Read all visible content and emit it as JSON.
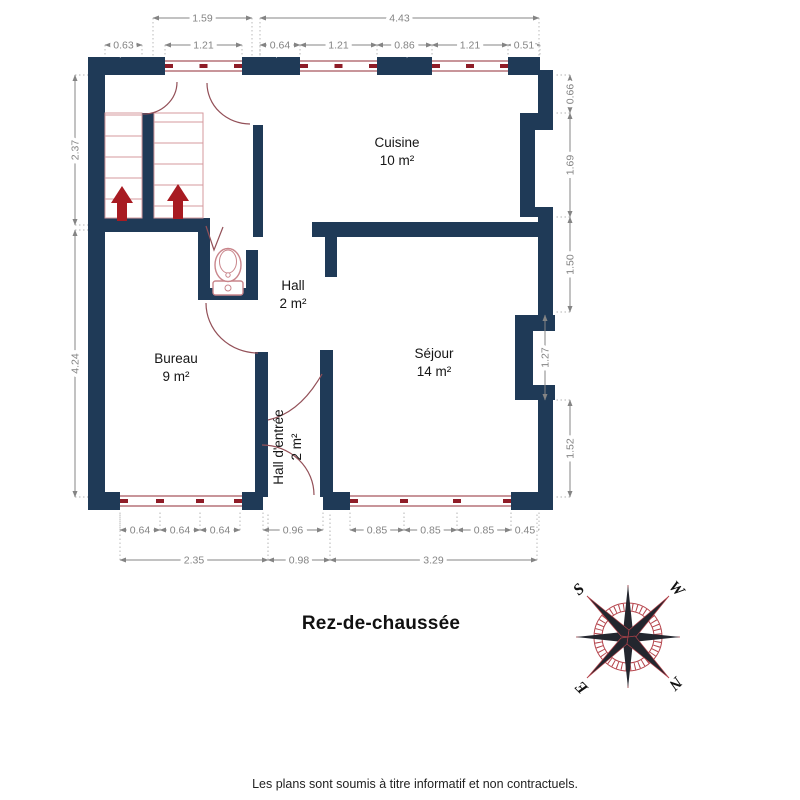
{
  "plan": {
    "title": "Rez-de-chaussée",
    "disclaimer": "Les plans sont soumis à titre informatif et non contractuels.",
    "rooms": [
      {
        "name": "Cuisine",
        "area": "10 m²",
        "x": 397,
        "y": 147,
        "rotate": 0
      },
      {
        "name": "Hall",
        "area": "2 m²",
        "x": 293,
        "y": 290,
        "rotate": 0
      },
      {
        "name": "Bureau",
        "area": "9 m²",
        "x": 176,
        "y": 363,
        "rotate": 0
      },
      {
        "name": "Séjour",
        "area": "14 m²",
        "x": 434,
        "y": 358,
        "rotate": 0
      },
      {
        "name": "Hall d'entrée",
        "area": "2 m²",
        "x": 283,
        "y": 447,
        "rotate": -90
      }
    ],
    "dimensions": {
      "horizontal": [
        {
          "value": "1.59",
          "x1": 153,
          "x2": 252,
          "y": 18,
          "ext": 57
        },
        {
          "value": "4.43",
          "x1": 260,
          "x2": 539,
          "y": 18,
          "ext": 57
        },
        {
          "value": "0.63",
          "x1": 105,
          "x2": 142,
          "y": 45,
          "ext": 57
        },
        {
          "value": "1.21",
          "x1": 165,
          "x2": 242,
          "y": 45,
          "ext": 57
        },
        {
          "value": "0.64",
          "x1": 260,
          "x2": 300,
          "y": 45,
          "ext": 57
        },
        {
          "value": "1.21",
          "x1": 300,
          "x2": 377,
          "y": 45,
          "ext": 57
        },
        {
          "value": "0.86",
          "x1": 377,
          "x2": 432,
          "y": 45,
          "ext": 57
        },
        {
          "value": "1.21",
          "x1": 432,
          "x2": 508,
          "y": 45,
          "ext": 57
        },
        {
          "value": "0.51",
          "x1": 508,
          "x2": 540,
          "y": 45,
          "ext": 57
        },
        {
          "value": "0.64",
          "x1": 120,
          "x2": 160,
          "y": 530,
          "ext": 512
        },
        {
          "value": "0.64",
          "x1": 160,
          "x2": 200,
          "y": 530,
          "ext": 512
        },
        {
          "value": "0.64",
          "x1": 200,
          "x2": 240,
          "y": 530,
          "ext": 512
        },
        {
          "value": "0.96",
          "x1": 263,
          "x2": 323,
          "y": 530,
          "ext": 512
        },
        {
          "value": "0.85",
          "x1": 350,
          "x2": 404,
          "y": 530,
          "ext": 512
        },
        {
          "value": "0.85",
          "x1": 404,
          "x2": 457,
          "y": 530,
          "ext": 512
        },
        {
          "value": "0.85",
          "x1": 457,
          "x2": 511,
          "y": 530,
          "ext": 512
        },
        {
          "value": "0.45",
          "x1": 511,
          "x2": 539,
          "y": 530,
          "ext": 512
        },
        {
          "value": "2.35",
          "x1": 120,
          "x2": 268,
          "y": 560,
          "ext": 512
        },
        {
          "value": "0.98",
          "x1": 268,
          "x2": 330,
          "y": 560,
          "ext": 512
        },
        {
          "value": "3.29",
          "x1": 330,
          "x2": 537,
          "y": 560,
          "ext": 512
        }
      ],
      "vertical": [
        {
          "value": "2.37",
          "y1": 75,
          "y2": 225,
          "x": 75,
          "ext": 88
        },
        {
          "value": "4.24",
          "y1": 230,
          "y2": 497,
          "x": 75,
          "ext": 88
        },
        {
          "value": "0.66",
          "y1": 75,
          "y2": 113,
          "x": 570,
          "ext": 555
        },
        {
          "value": "1.69",
          "y1": 113,
          "y2": 217,
          "x": 570,
          "ext": 555
        },
        {
          "value": "1.50",
          "y1": 217,
          "y2": 312,
          "x": 570,
          "ext": 555
        },
        {
          "value": "1.27",
          "y1": 315,
          "y2": 400,
          "x": 545,
          "ext": null
        },
        {
          "value": "1.52",
          "y1": 400,
          "y2": 497,
          "x": 570,
          "ext": 555
        }
      ]
    },
    "windows": [
      {
        "x1": 165,
        "x2": 242,
        "y": 66,
        "mullions": []
      },
      {
        "x1": 300,
        "x2": 377,
        "y": 66,
        "mullions": []
      },
      {
        "x1": 432,
        "x2": 508,
        "y": 66,
        "mullions": []
      },
      {
        "x1": 120,
        "x2": 242,
        "y": 501,
        "mullions": [
          160,
          200
        ]
      },
      {
        "x1": 350,
        "x2": 511,
        "y": 501,
        "mullions": [
          404,
          457
        ]
      }
    ],
    "compass": {
      "letters": [
        {
          "t": "S",
          "x": 582,
          "y": 593,
          "r": -42
        },
        {
          "t": "W",
          "x": 673,
          "y": 592,
          "r": 45
        },
        {
          "t": "E",
          "x": 585,
          "y": 684,
          "r": -135
        },
        {
          "t": "N",
          "x": 672,
          "y": 680,
          "r": 135
        }
      ]
    },
    "colors": {
      "wall": "#1f3a57",
      "window_line": "#a8565e",
      "window_tick": "#8f1d28",
      "stair_line": "#d4999e",
      "arrow": "#a81b22",
      "door_arc": "#935058",
      "toilet": "#c9858b",
      "dimension": "#848484",
      "extension": "#b3b3b3",
      "compass_red": "#b5444c",
      "compass_dark": "#23262e"
    }
  }
}
